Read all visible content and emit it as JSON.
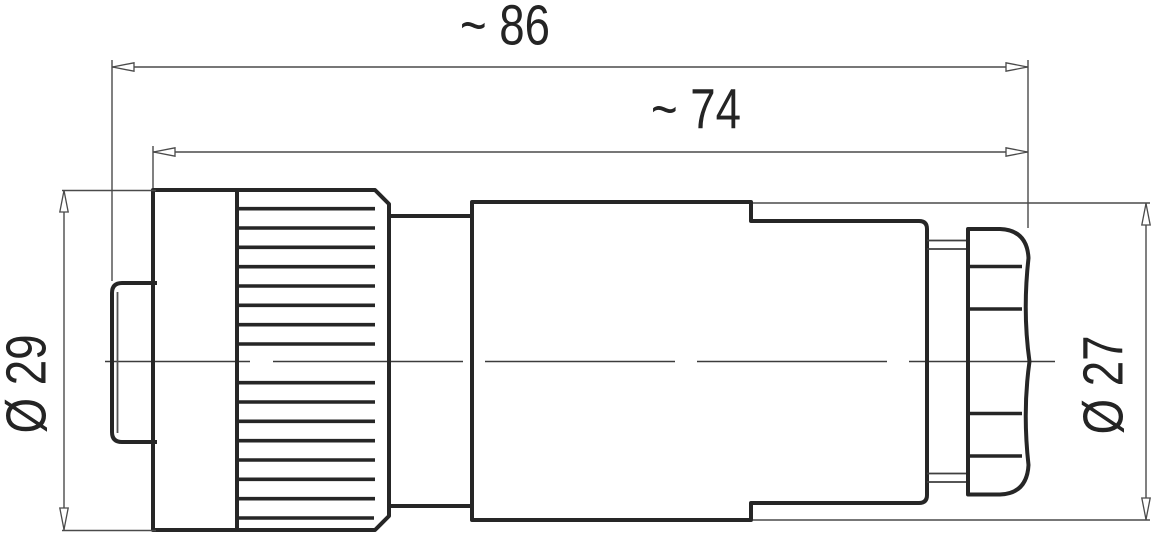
{
  "drawing": {
    "kind": "technical-dimension-drawing",
    "palette": {
      "background": "#ffffff",
      "outline_ink": "#262626",
      "thin_line_ink": "#4a4a4a",
      "text_ink": "#242424"
    },
    "dimensions": {
      "overall_length": {
        "label": "~ 86",
        "value": 86,
        "approximate": true
      },
      "body_length": {
        "label": "~ 74",
        "value": 74,
        "approximate": true
      },
      "front_diameter": {
        "label": "Ø 29",
        "value": 29,
        "diameter": true
      },
      "rear_diameter": {
        "label": "Ø 27",
        "value": 27,
        "diameter": true
      }
    }
  }
}
